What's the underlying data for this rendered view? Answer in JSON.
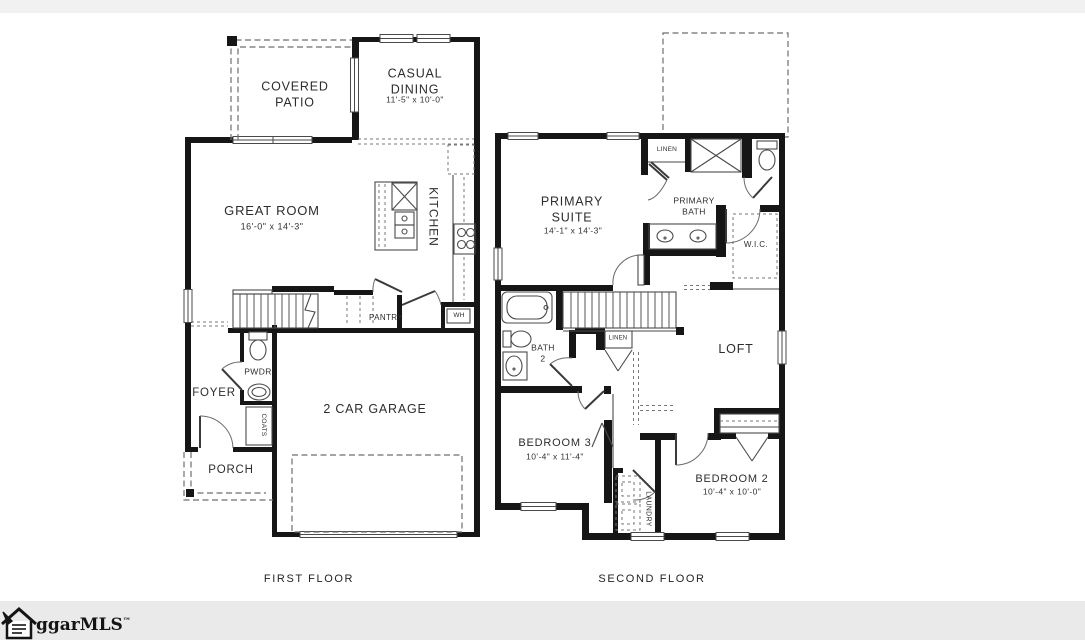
{
  "watermark": {
    "brand": "ggarMLS",
    "trademark": "™"
  },
  "first_floor": {
    "caption": "FIRST FLOOR",
    "rooms": {
      "covered_patio": {
        "name": "COVERED\nPATIO"
      },
      "casual_dining": {
        "name": "CASUAL\nDINING",
        "dims": "11'-5\" x 10'-0\""
      },
      "great_room": {
        "name": "GREAT ROOM",
        "dims": "16'-0\" x 14'-3\""
      },
      "kitchen": {
        "name": "KITCHEN"
      },
      "pantry": {
        "name": "PANTRY"
      },
      "water_heater": {
        "name": "WH"
      },
      "powder": {
        "name": "PWDR"
      },
      "foyer": {
        "name": "FOYER"
      },
      "coats": {
        "name": "COATS"
      },
      "porch": {
        "name": "PORCH"
      },
      "garage": {
        "name": "2 CAR GARAGE"
      }
    }
  },
  "second_floor": {
    "caption": "SECOND FLOOR",
    "rooms": {
      "primary_suite": {
        "name": "PRIMARY\nSUITE",
        "dims": "14'-1\" x 14'-3\""
      },
      "linen_upper": {
        "name": "LINEN"
      },
      "primary_bath": {
        "name": "PRIMARY\nBATH"
      },
      "wic": {
        "name": "W.I.C."
      },
      "bath_2": {
        "name": "BATH\n2"
      },
      "linen_hall": {
        "name": "LINEN"
      },
      "loft": {
        "name": "LOFT"
      },
      "bedroom_3": {
        "name": "BEDROOM 3",
        "dims": "10'-4\" x 11'-4\""
      },
      "laundry": {
        "name": "LAUNDRY"
      },
      "bedroom_2": {
        "name": "BEDROOM 2",
        "dims": "10'-4\" x 10'-0\""
      }
    }
  }
}
